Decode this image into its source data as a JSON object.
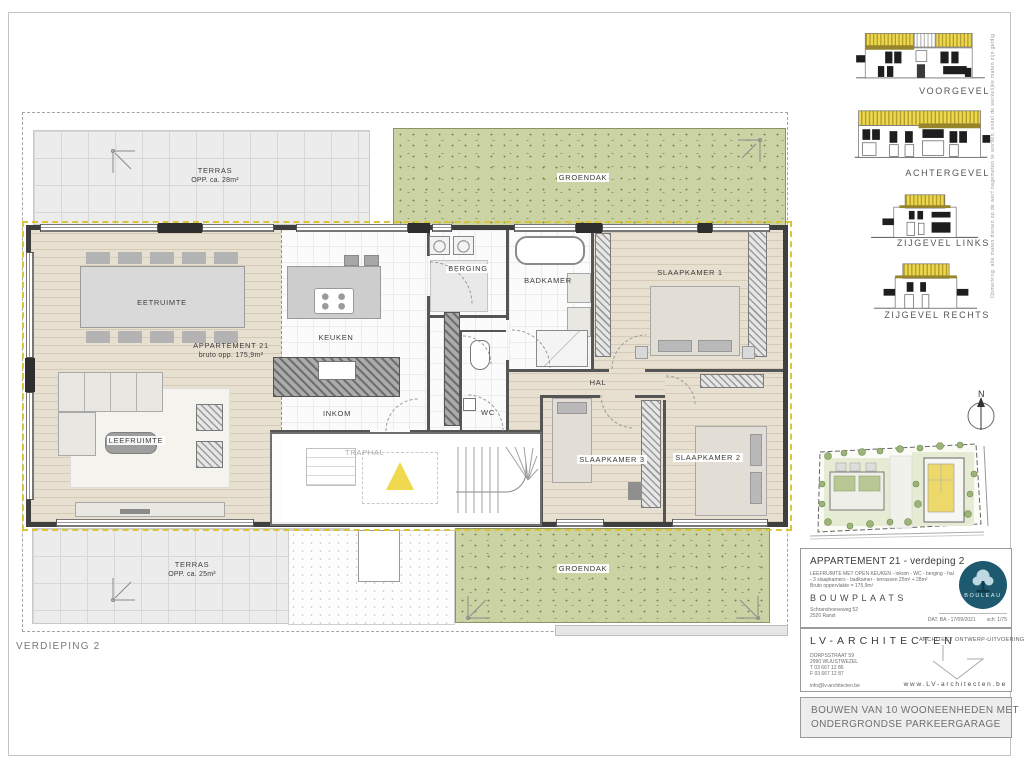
{
  "page": {
    "floor_label": "VERDIEPING 2",
    "north_label": "N"
  },
  "plan": {
    "apartment_name": "APPARTEMENT 21",
    "apartment_area": "bruto opp. 175,9m²",
    "terras_top": {
      "label": "TERRAS",
      "area": "OPP. ca. 28m²"
    },
    "terras_bottom": {
      "label": "TERRAS",
      "area": "OPP. ca. 25m²"
    },
    "groendak_top": "GROENDAK",
    "groendak_bottom": "GROENDAK",
    "rooms": {
      "eetruimte": "EETRUIMTE",
      "leefruimte": "LEEFRUIMTE",
      "keuken": "KEUKEN",
      "inkom": "INKOM",
      "berging": "BERGING",
      "badkamer": "BADKAMER",
      "wc": "WC",
      "hal": "HAL",
      "slaapkamer1": "SLAAPKAMER 1",
      "slaapkamer2": "SLAAPKAMER 2",
      "slaapkamer3": "SLAAPKAMER 3",
      "traphal": "TRAPHAL"
    }
  },
  "elevations": [
    {
      "label": "VOORGEVEL"
    },
    {
      "label": "ACHTERGEVEL"
    },
    {
      "label": "ZIJGEVEL LINKS"
    },
    {
      "label": "ZIJGEVEL RECHTS"
    }
  ],
  "side_note": "Opmerking: alle maten dienen op de werf nagemeten te worden, enkel de werkelijke maten zijn geldig",
  "titleblock": {
    "title": "APPARTEMENT 21 - verdeping 2",
    "description_line1": "LEEFRUIMTE MET OPEN KEUKEN - inkom - WC - berging - hal",
    "description_line2": "- 3 slaapkamers - badkamer - terrassen 25m² + 28m²",
    "description_line3": "Bruto oppervlakte = 175,9m²",
    "bouwplaats_label": "BOUWPLAATS",
    "bouwplaats_line1": "Schranshoeveweg 52",
    "bouwplaats_line2": "2520 Ranst",
    "date_scale": "DAT. BA - 17/09/2021        sch: 1/75",
    "logo_text": "BOULEAU",
    "architect_name": "LV-ARCHITECTEN",
    "architect_line1": "DORPSSTRAAT 59",
    "architect_line2": "2990 WUUSTWEZEL",
    "architect_line3": "T 03 667 12 86",
    "architect_line4": "F 03 667 12 87",
    "architect_email": "info@lv-architecten.be",
    "architect_role": "ARCHITECT ONTWERP-UITVOERING",
    "website": "www.LV-architecten.be",
    "project_title_line1": "BOUWEN VAN 10 WOONEENHEDEN MET",
    "project_title_line2": "ONDERGRONDSE PARKEERGARAGE"
  },
  "colors": {
    "groendak": "#cbd2a3",
    "insulation_yellow": "#d9c53a",
    "lift_yellow": "#f0d94e",
    "logo_teal": "#1d5a70",
    "wood_floor": "#e7dfd0"
  }
}
